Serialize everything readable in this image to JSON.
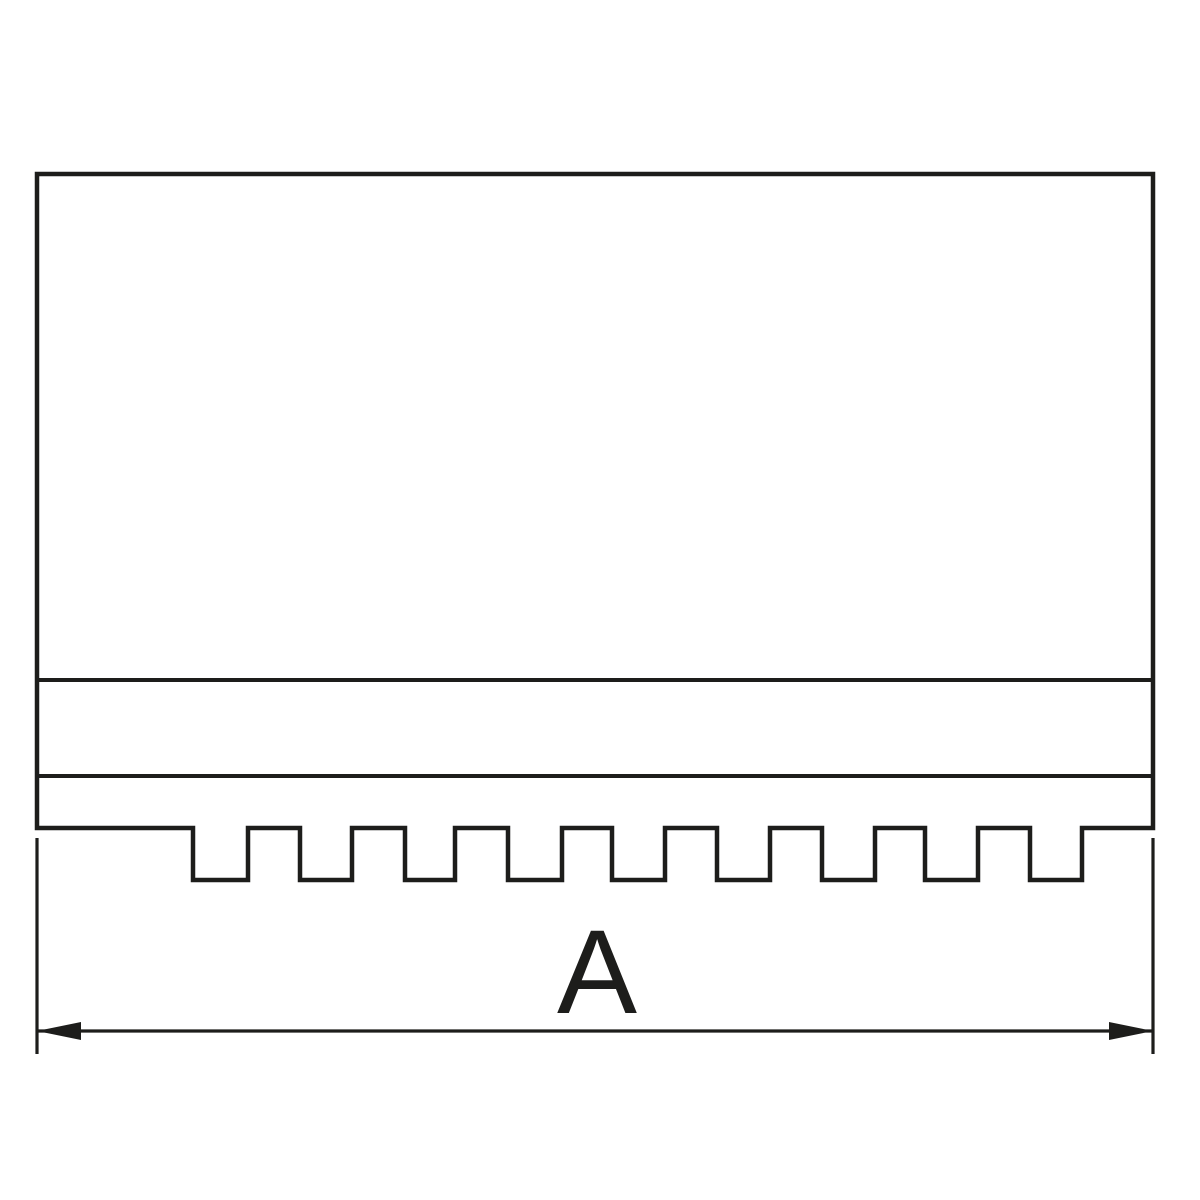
{
  "drawing": {
    "kind": "technical-line-drawing",
    "background_color": "#ffffff",
    "line_color": "#1d1d1b",
    "body": {
      "x_left": 37,
      "x_right": 1153,
      "y_top": 174,
      "y_step_line_1": 680,
      "y_step_line_2": 776,
      "y_serration_base": 828,
      "y_tooth_bottom": 880
    },
    "teeth": {
      "count": 9,
      "down_segments": [
        [
          193,
          248
        ],
        [
          300,
          352
        ],
        [
          405,
          455
        ],
        [
          508,
          562
        ],
        [
          612,
          665
        ],
        [
          717,
          770
        ],
        [
          822,
          875
        ],
        [
          925,
          978
        ],
        [
          1030,
          1082
        ]
      ]
    },
    "dimension": {
      "label": "A",
      "line_y": 1031,
      "x_left": 37,
      "x_right": 1153,
      "extension_top_y": 838,
      "extension_bottom_y": 1054,
      "arrow_length": 44,
      "arrow_half_width": 9,
      "label_x": 597,
      "label_baseline_y": 1013,
      "label_font_size": 120
    }
  }
}
